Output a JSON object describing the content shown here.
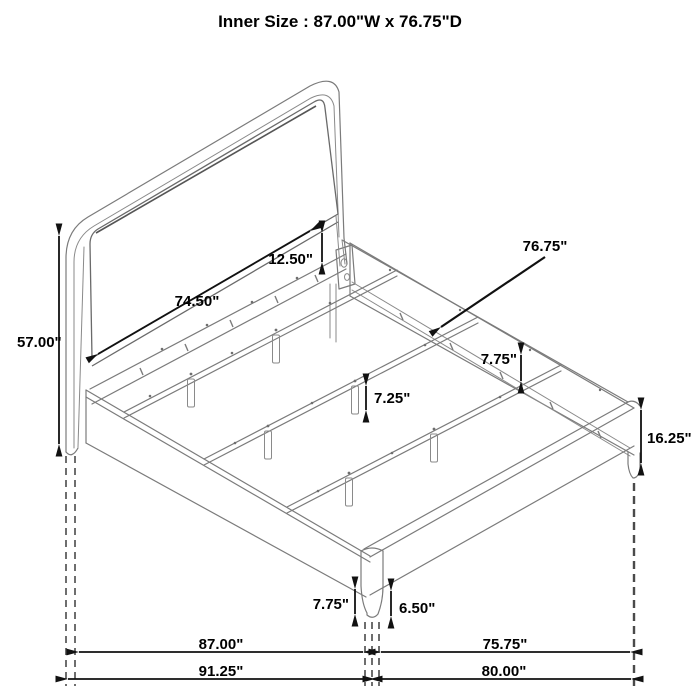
{
  "title": "Inner Size : 87.00\"W x 76.75\"D",
  "colors": {
    "drawing_line": "#7b7b7b",
    "dimension_line": "#111111",
    "background": "#ffffff"
  },
  "dimensions": {
    "headboard_height": "57.00\"",
    "headboard_inner_width": "74.50\"",
    "panel_to_rail_gap": "12.50\"",
    "inner_depth": "76.75\"",
    "rail_to_slat": "7.75\"",
    "slat_leg_height": "7.25\"",
    "frame_side_height": "16.25\"",
    "front_leg_height": "7.75\"",
    "front_leg_taper": "6.50\"",
    "inner_width": "87.00\"",
    "foot_inner_depth": "75.75\"",
    "overall_width": "91.25\"",
    "overall_depth": "80.00\""
  }
}
